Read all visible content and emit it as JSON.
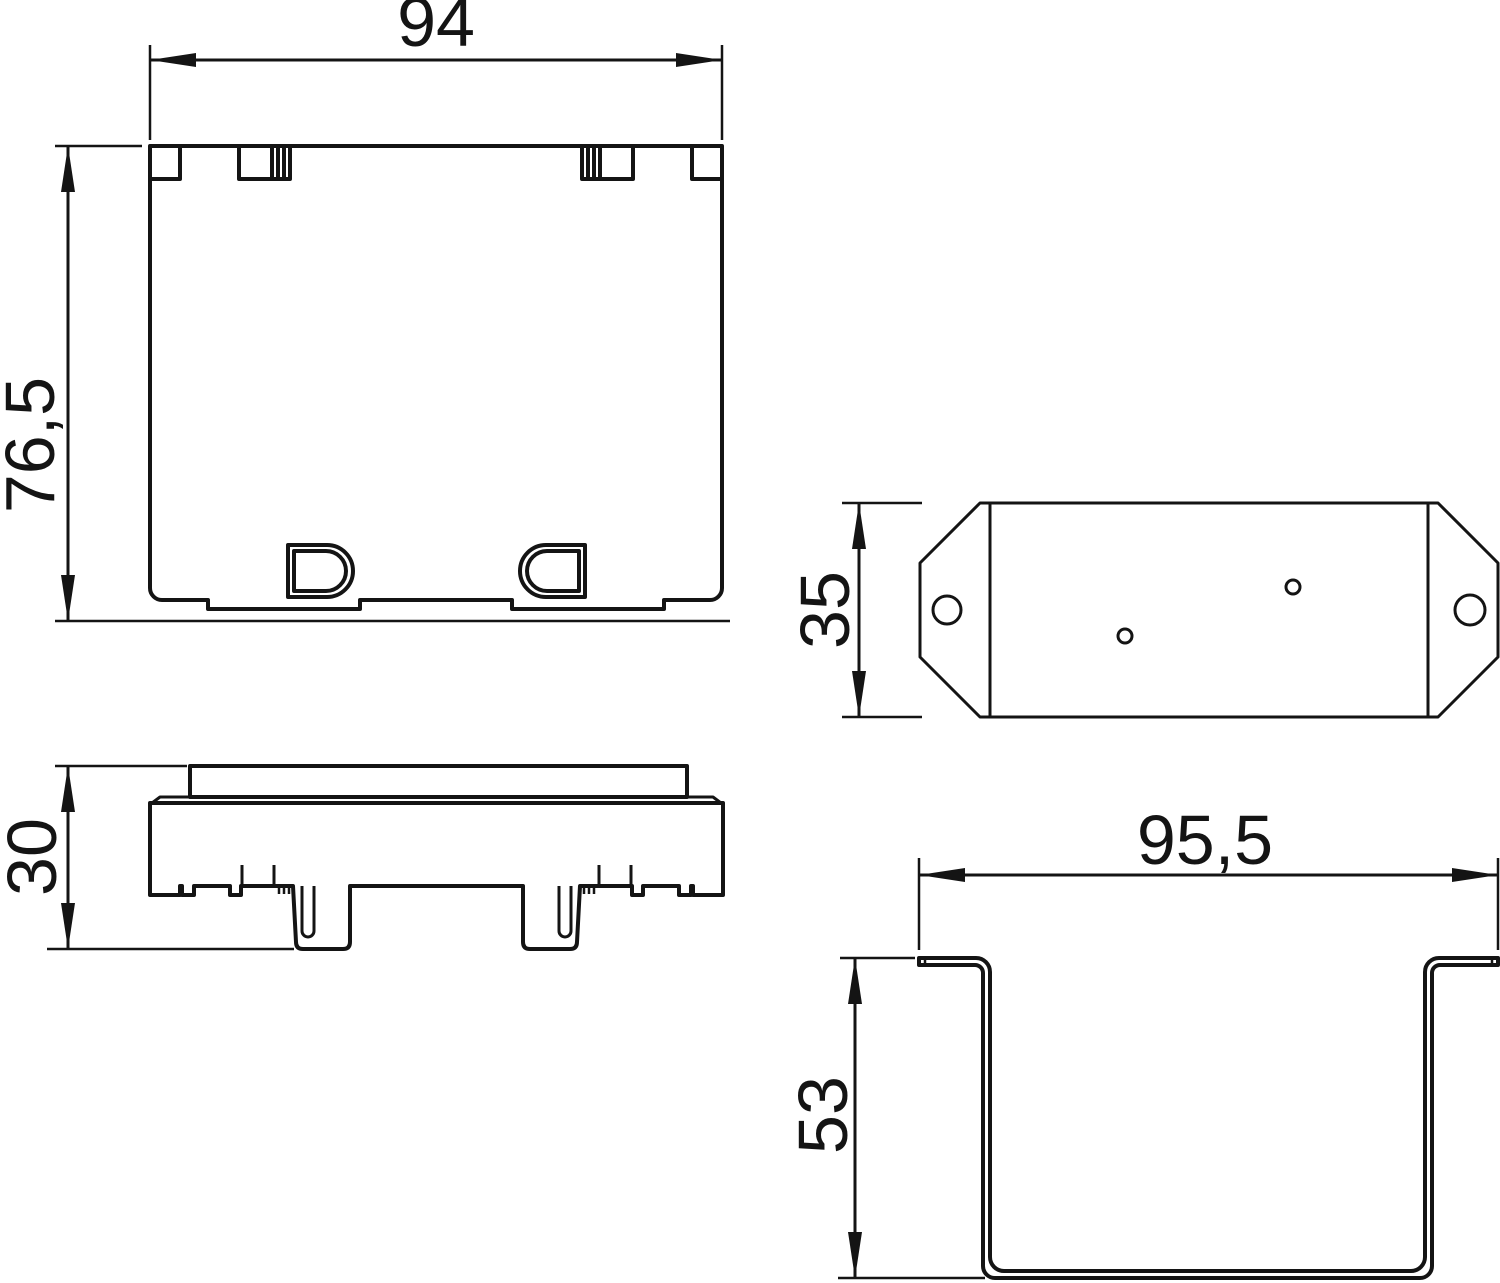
{
  "drawing": {
    "type": "technical-dimension-drawing",
    "background_color": "#ffffff",
    "line_color": "#141414",
    "views": {
      "front": {
        "name": "front-view-cover",
        "width_label": "94",
        "height_label": "76,5"
      },
      "side": {
        "name": "side-view-cover",
        "height_label": "30"
      },
      "plate": {
        "name": "mounting-plate-top-view",
        "height_label": "35"
      },
      "channel": {
        "name": "channel-section-view",
        "width_label": "95,5",
        "depth_label": "53"
      }
    }
  }
}
